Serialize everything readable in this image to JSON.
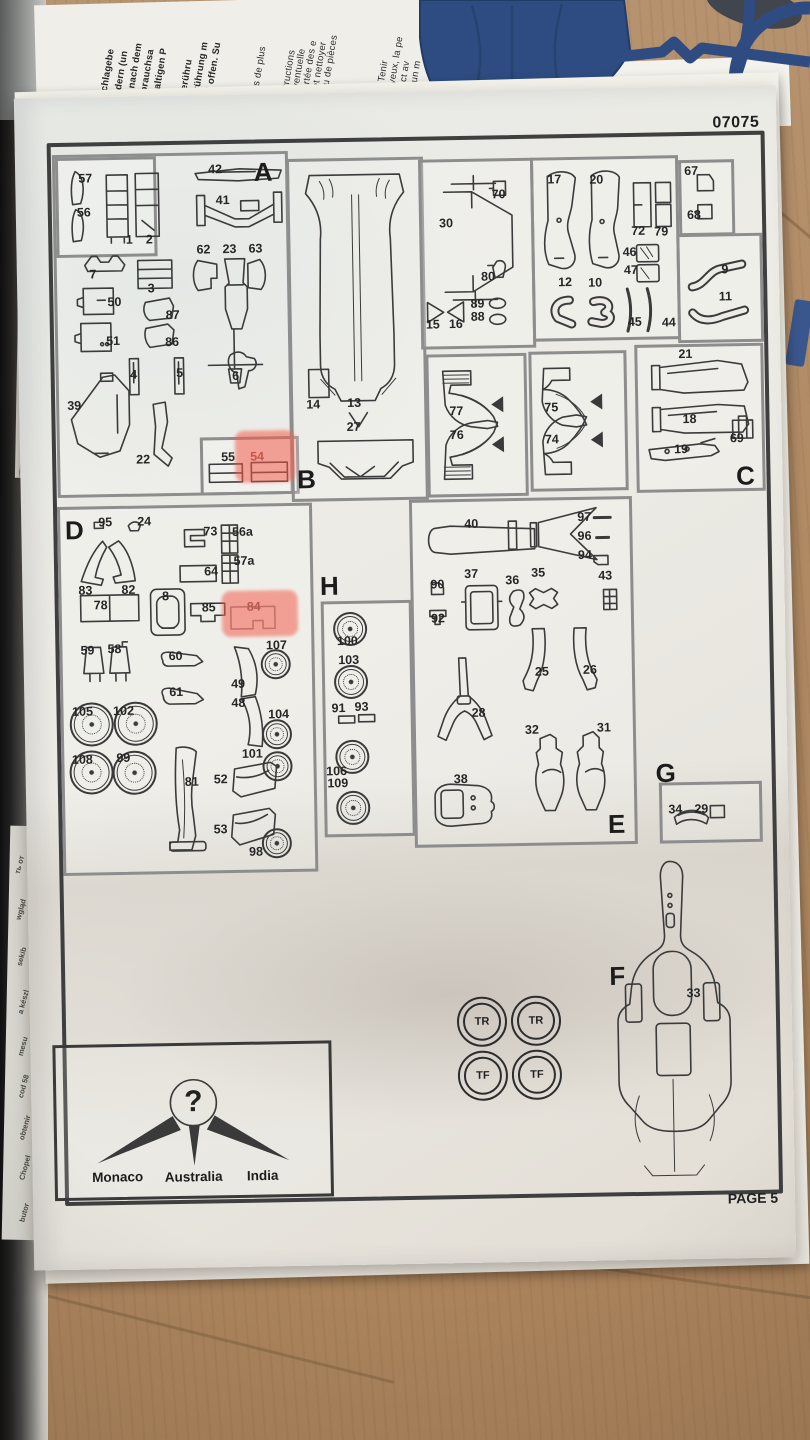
{
  "kit_number": "07075",
  "page_label": "PAGE 5",
  "sections": {
    "A": "A",
    "B": "B",
    "C": "C",
    "D": "D",
    "E": "E",
    "F": "F",
    "G": "G",
    "H": "H"
  },
  "mystery": {
    "symbol": "?",
    "countries": [
      "Monaco",
      "Australia",
      "India"
    ]
  },
  "tires": [
    "TR",
    "TR",
    "TF",
    "TF"
  ],
  "p": {
    "1": "1",
    "2": "2",
    "3": "3",
    "4": "4",
    "5": "5",
    "6": "6",
    "7": "7",
    "8": "8",
    "9": "9",
    "10": "10",
    "11": "11",
    "12": "12",
    "13": "13",
    "14": "14",
    "15": "15",
    "16": "16",
    "17": "17",
    "18": "18",
    "19": "19",
    "20": "20",
    "21": "21",
    "22": "22",
    "23": "23",
    "24": "24",
    "25": "25",
    "26": "26",
    "27": "27",
    "28": "28",
    "29": "29",
    "30": "30",
    "31": "31",
    "32": "32",
    "33": "33",
    "34": "34",
    "35": "35",
    "36": "36",
    "37": "37",
    "38": "38",
    "39": "39",
    "40": "40",
    "41": "41",
    "42": "42",
    "43": "43",
    "44": "44",
    "45": "45",
    "46": "46",
    "47": "47",
    "48": "48",
    "49": "49",
    "50": "50",
    "51": "51",
    "52": "52",
    "53": "53",
    "54": "54",
    "55": "55",
    "56": "56",
    "56a": "56a",
    "57": "57",
    "57a": "57a",
    "58": "58",
    "59": "59",
    "60": "60",
    "61": "61",
    "62": "62",
    "63": "63",
    "64": "64",
    "67": "67",
    "68": "68",
    "69": "69",
    "70": "70",
    "72": "72",
    "73": "73",
    "74": "74",
    "75": "75",
    "76": "76",
    "77": "77",
    "78": "78",
    "79": "79",
    "80": "80",
    "81": "81",
    "82": "82",
    "83": "83",
    "84": "84",
    "85": "85",
    "86": "86",
    "87": "87",
    "88": "88",
    "89": "89",
    "90": "90",
    "91": "91",
    "92": "92",
    "93": "93",
    "94": "94",
    "95": "95",
    "96": "96",
    "97": "97",
    "98": "98",
    "99": "99",
    "100": "100",
    "101": "101",
    "102": "102",
    "103": "103",
    "104": "104",
    "105": "105",
    "106": "106",
    "107": "107",
    "108": "108",
    "109": "109"
  },
  "bg": {
    "de": [
      "nen!",
      "gen und nachschlagebe",
      "te von Kleinkindern (un",
      "die Werkzeuge nach dem",
      "oder in der Gebrauchsa",
      "lösungsmittelhaltigen P",
      "n fernhalten!",
      "und Mund in Berühru",
      "m Falle der Berührung m",
      "te dieses dabei offen. Su"
    ],
    "fr": [
      "ment aux enfants de plus",
      "et suivre les instructions",
      "r consultation éventuelle",
      "oires hors de portée des e",
      "aver les mains et nettoyer",
      "tenus dans le jeu de pièces",
      "ire ou de fumer. Tenir",
      "ontact avec les yeux, la pe",
      "En cas de contact av",
      "immédiatement un m"
    ],
    "edge": [
      "ть от",
      "wgląd",
      "sekib",
      "a készl",
      "mesu",
      "cod 58",
      "obtenir",
      "Chopel",
      "butor"
    ]
  },
  "colors": {
    "highlight": "#f35c4c",
    "sprue_blue": "#2e4c82",
    "wood": "#b08a63",
    "paper": "#ecebe5",
    "box_border": "#8d8d8d",
    "outer_border": "#3f3f3f"
  }
}
